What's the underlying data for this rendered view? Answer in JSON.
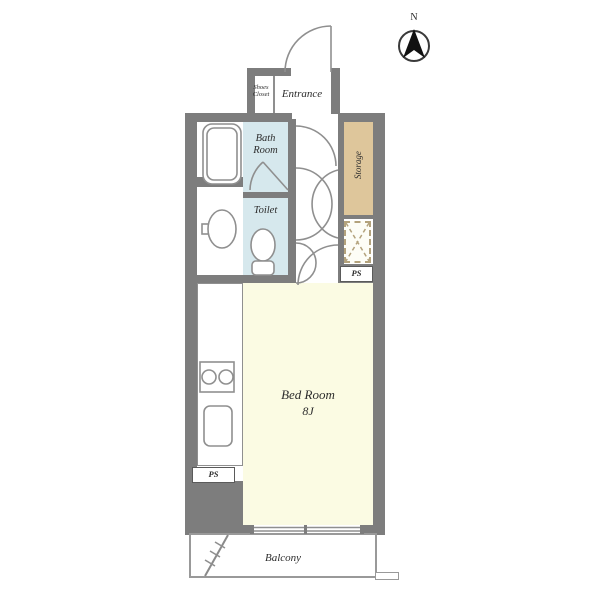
{
  "compass": {
    "label": "N"
  },
  "rooms": {
    "shoes_closet": {
      "label": "Shoes\nCloset"
    },
    "entrance": {
      "label": "Entrance"
    },
    "bath_room": {
      "label": "Bath\nRoom"
    },
    "toilet": {
      "label": "Toilet"
    },
    "storage": {
      "label": "Storage"
    },
    "bed_room": {
      "label": "Bed Room",
      "size": "8J"
    },
    "balcony": {
      "label": "Balcony"
    },
    "ps_upper": {
      "label": "PS"
    },
    "ps_lower": {
      "label": "PS"
    }
  },
  "colors": {
    "wall": "#7d7d7d",
    "line": "#8f8f8f",
    "water": "#d6e8ed",
    "storage": "#dec69b",
    "bedroom": "#fbfbe3",
    "text": "#2d2d2d",
    "balc": "#999999",
    "meter": "#b3a27c",
    "compass": "#111111"
  }
}
